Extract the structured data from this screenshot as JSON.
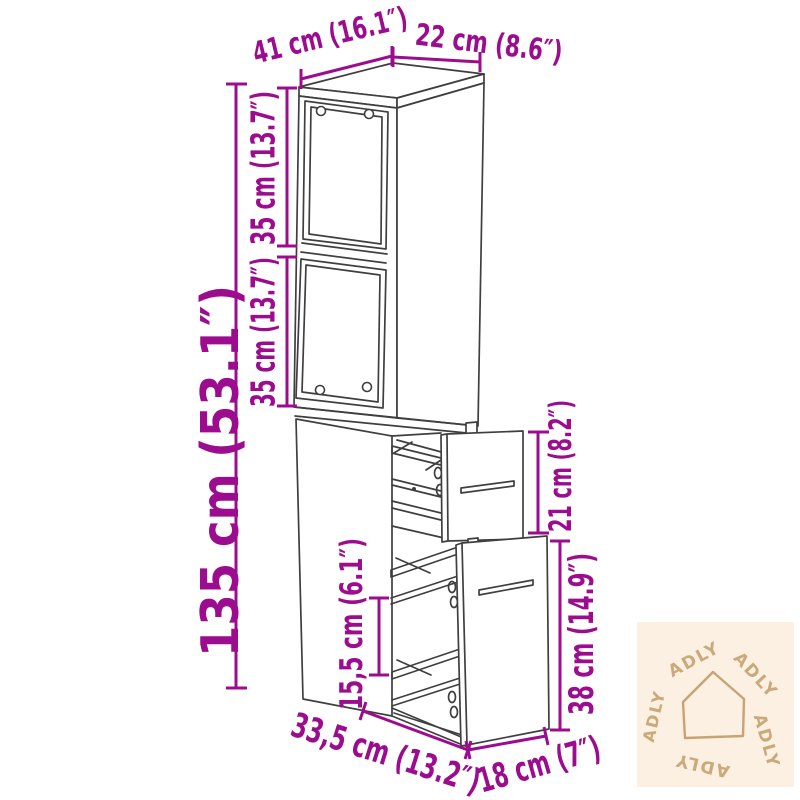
{
  "dimensions": {
    "width_top": "41 cm (16.1″)",
    "depth_top": "22 cm (8.6″)",
    "height_total": "135 cm (53.1″)",
    "shelf_top": "35 cm (13.7″)",
    "shelf_bottom": "35 cm (13.7″)",
    "drawer_top_height": "21 cm (8.2″)",
    "drawer_bottom_height": "38 cm (14.9″)",
    "interior_clearance": "15,5 cm (6.1″)",
    "depth_bottom": "33,5 cm (13.2″)",
    "drawer_width": "18 cm (7″)"
  },
  "watermark": {
    "brand": "ADLY"
  },
  "colors": {
    "dimension": "#9c0c8e",
    "line": "#3f3f3f",
    "watermark_bg": "#fbf0e1",
    "watermark_fg": "#c6a473",
    "background": "#ffffff"
  }
}
